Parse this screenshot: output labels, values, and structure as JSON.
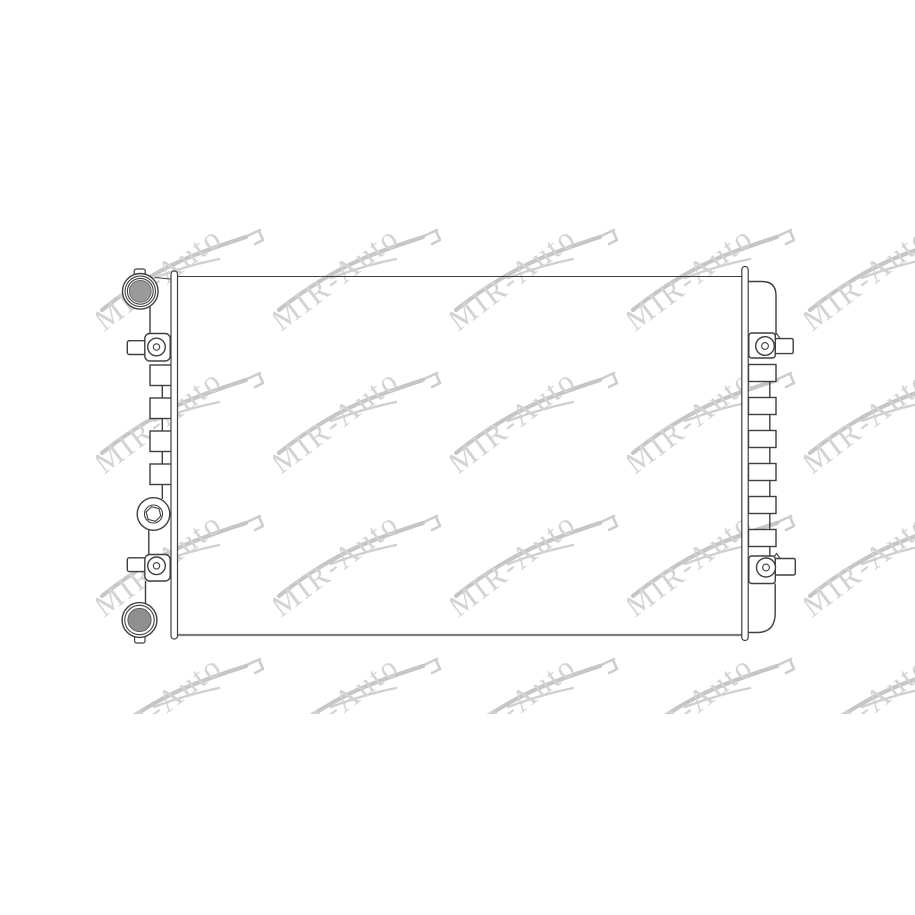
{
  "background": "#ffffff",
  "watermark": {
    "text": "MIR-Auto",
    "text_color": "#c9c9c9",
    "swoosh_color": "#b9b9b9"
  },
  "drawing": {
    "subject": "radiator-technical-line-drawing",
    "line_color": "#3f3f3f",
    "soft_line_color": "#7d7d7d",
    "inlet_port_fill": "#9a9a9a",
    "outlet_port_fill": "#8f8f8f"
  }
}
